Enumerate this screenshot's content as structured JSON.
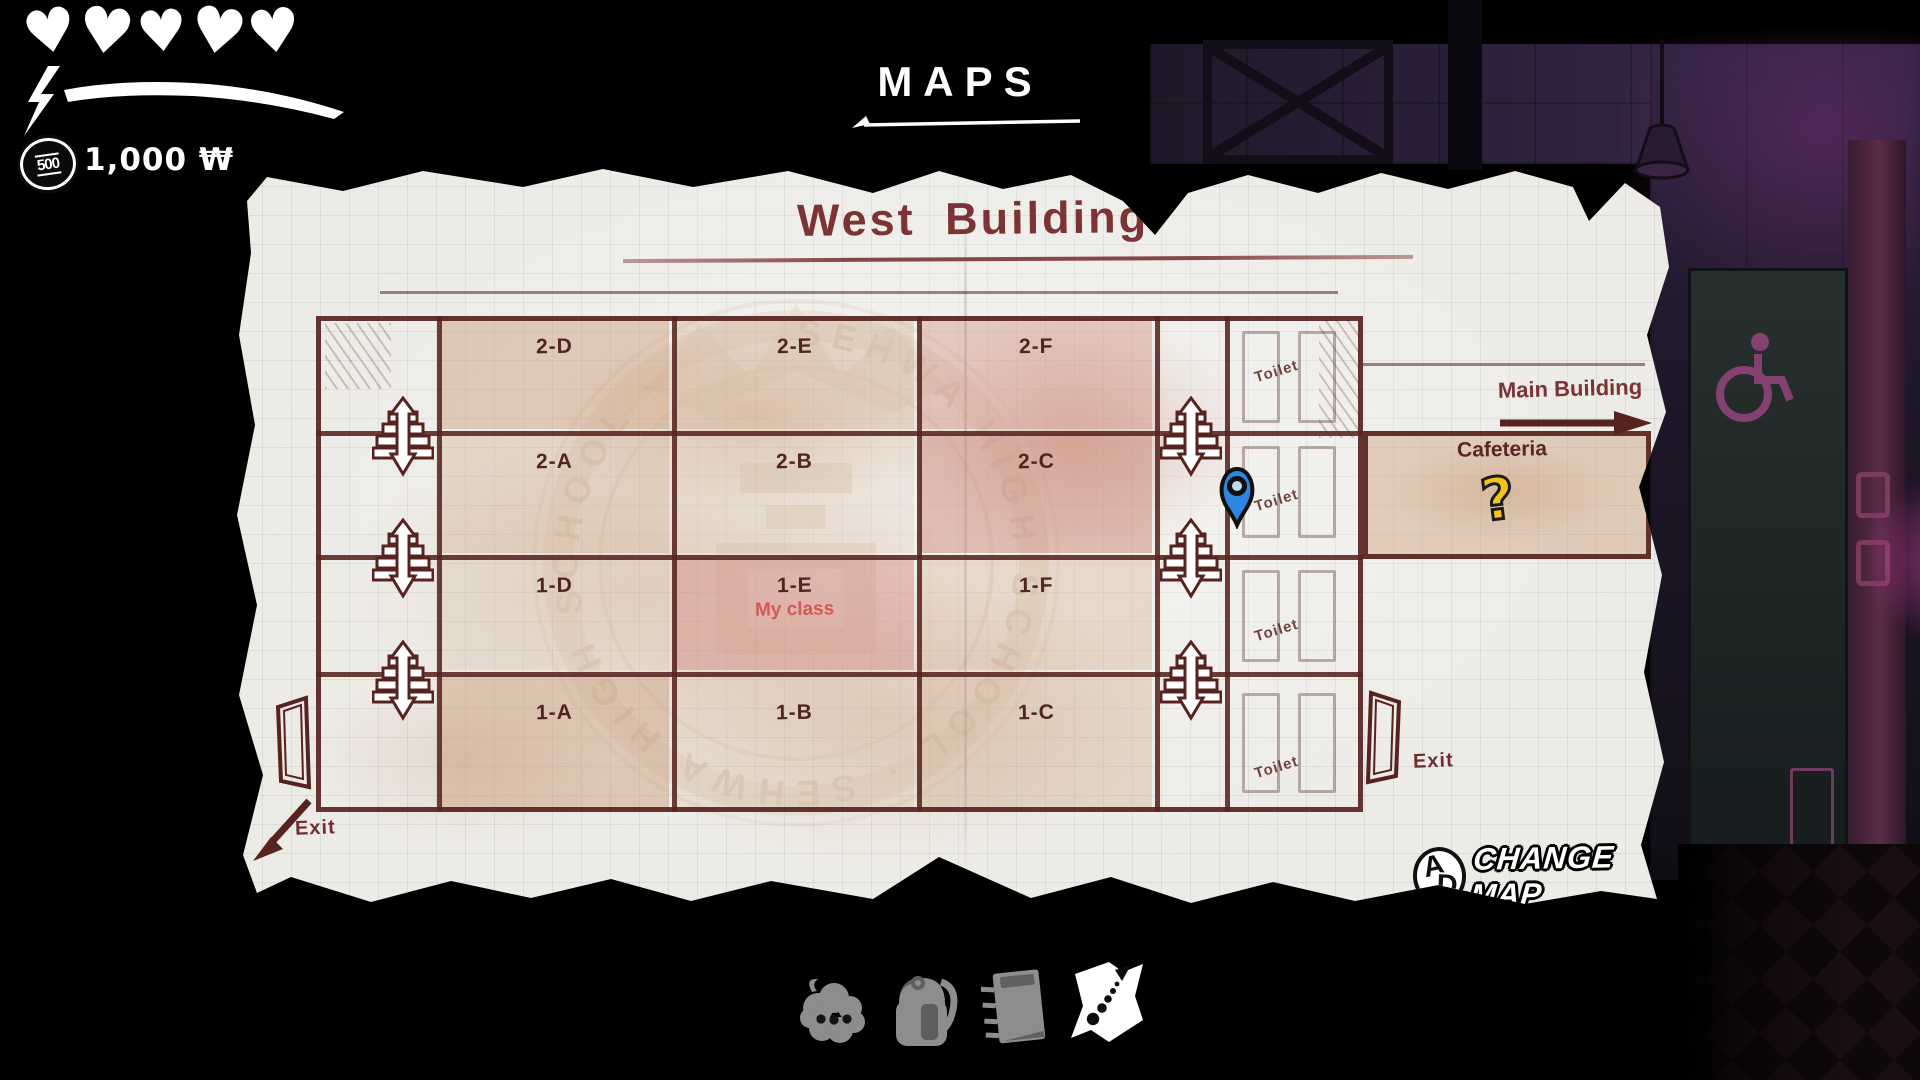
{
  "hud": {
    "hearts": 5,
    "heart_icon": "heart",
    "stamina_icon": "lightning-bolt",
    "coin_value": "500",
    "money": "1,000 ₩"
  },
  "header": {
    "title": "MAPS"
  },
  "map": {
    "title": "West Building",
    "watermark_text": "SEHWA HIGH SCHOOL · SEHWA HIGH SCHOOL ·",
    "rooms": [
      {
        "label": "2-D"
      },
      {
        "label": "2-E"
      },
      {
        "label": "2-F"
      },
      {
        "label": "2-A"
      },
      {
        "label": "2-B"
      },
      {
        "label": "2-C"
      },
      {
        "label": "1-D"
      },
      {
        "label": "1-E",
        "sublabel": "My class"
      },
      {
        "label": "1-F"
      },
      {
        "label": "1-A"
      },
      {
        "label": "1-B"
      },
      {
        "label": "1-C"
      }
    ],
    "toilet_labels": [
      "Toilet",
      "Toilet",
      "Toilet",
      "Toilet"
    ],
    "cafeteria_label": "Cafeteria",
    "main_building_label": "Main Building",
    "exit_left_label": "Exit",
    "exit_right_label": "Exit",
    "markers": {
      "player_pin": "blue-location-pin",
      "objective": "?",
      "pin_color": "#2e86e0",
      "objective_color": "#f2c31b"
    }
  },
  "change_map": {
    "key_left": "A",
    "key_right": "D",
    "label": "CHANGE MAP"
  },
  "tabbar": {
    "tabs": [
      {
        "icon": "thought-cloud",
        "active": false
      },
      {
        "icon": "backpack",
        "active": false
      },
      {
        "icon": "notebook",
        "active": false
      },
      {
        "icon": "folded-map",
        "active": true
      }
    ]
  },
  "colors": {
    "ink": "#57231f",
    "paper": "#edebe6",
    "accent_red": "#d4575a",
    "wall_purple": "#2f2240"
  }
}
